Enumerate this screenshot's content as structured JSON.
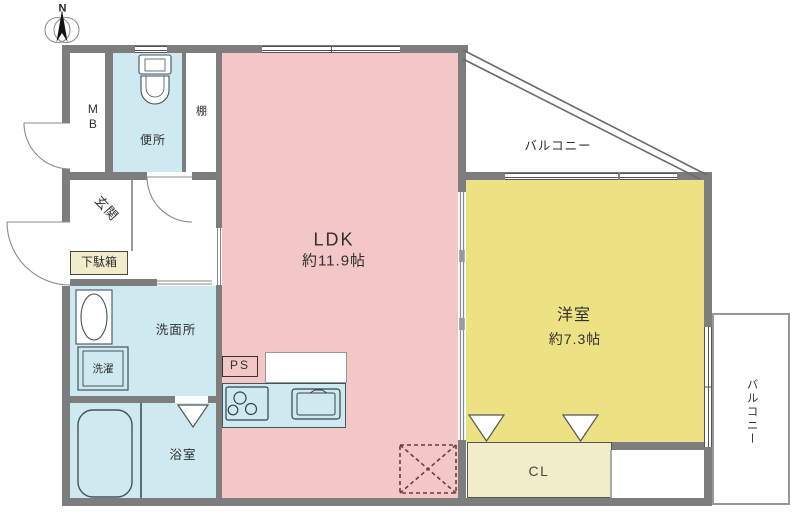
{
  "compass": {
    "north_label": "N"
  },
  "labels": {
    "mb": "MB",
    "toilet": "便所",
    "shelf": "棚",
    "entrance": "玄関",
    "shoe_cabinet": "下駄箱",
    "washroom": "洗面所",
    "laundry": "洗濯",
    "bathroom": "浴室",
    "ldk_name": "LDK",
    "ldk_size": "約11.9帖",
    "pipe_space": "PS",
    "western_room_name": "洋室",
    "western_room_size": "約7.3帖",
    "closet": "CL",
    "balcony_top": "バルコニー",
    "balcony_right": "バルコニー"
  },
  "colors": {
    "ldk_floor": "#f2c7c5",
    "western_room_floor": "#ece284",
    "water_area_floor": "#cfe9f1",
    "storage_fill": "#f1ecc9",
    "wall": "#7d7d7d",
    "line": "#555555"
  }
}
